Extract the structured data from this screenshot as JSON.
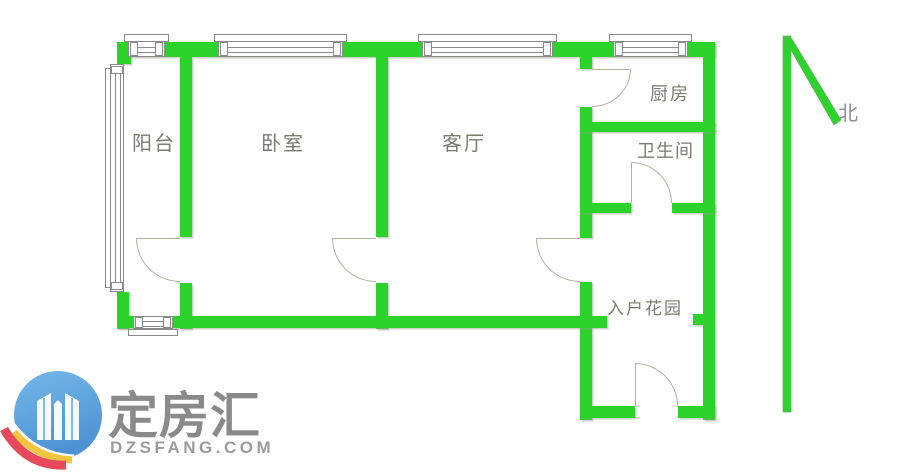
{
  "floorplan": {
    "rooms": [
      {
        "id": "balcony",
        "label": "阳台"
      },
      {
        "id": "bedroom",
        "label": "卧室"
      },
      {
        "id": "living-room",
        "label": "客厅"
      },
      {
        "id": "kitchen",
        "label": "厨房"
      },
      {
        "id": "bathroom",
        "label": "卫生间"
      },
      {
        "id": "entry-garden",
        "label": "入户花园"
      }
    ],
    "compass": {
      "label": "北",
      "direction": "north"
    },
    "colors": {
      "wall": "#2BD32B",
      "window_frame": "#8A8A8A",
      "door_swing": "#B8B09E",
      "room_label": "#7B7B73"
    }
  },
  "watermark": {
    "brand_name": "定房汇",
    "website": "DZSFANG.COM",
    "logo_icon": "twin-towers-circle-icon",
    "colors": {
      "circle": "#5FA8DE",
      "swoosh_yellow": "#F3C43D",
      "swoosh_red": "#E8495C",
      "text": "#8A8A8A"
    }
  }
}
